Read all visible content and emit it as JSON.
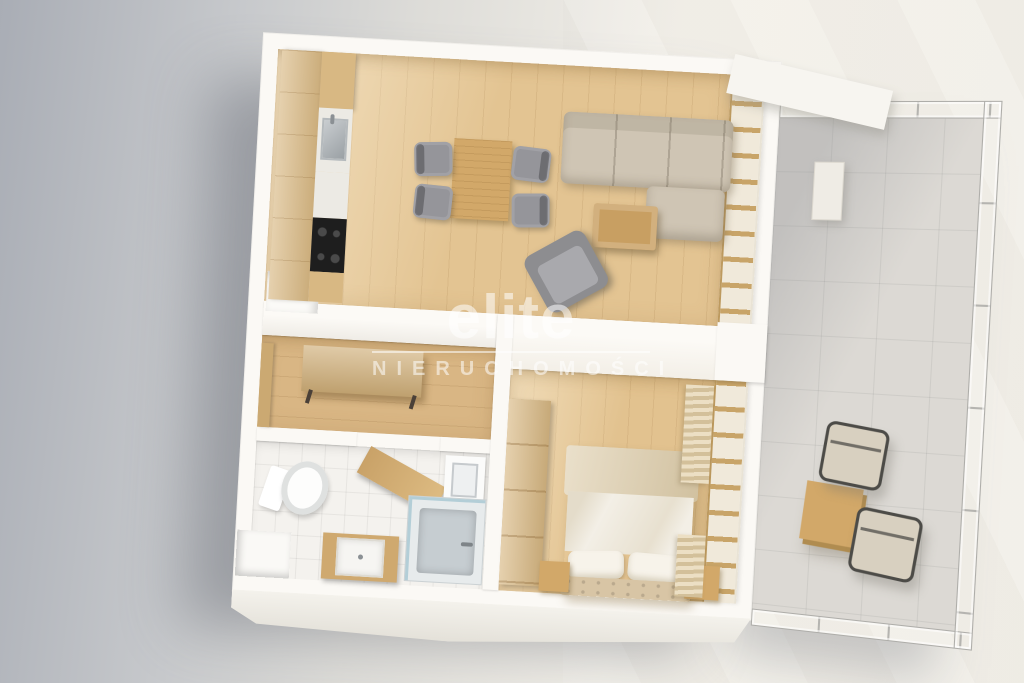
{
  "watermark": {
    "brand": "elite",
    "subtitle": "NIERUCHOMOŚCI"
  },
  "palette": {
    "bg-left": "#a9adb5",
    "bg-mid": "#c7c9cc",
    "bg-right": "#f3f0e9",
    "wall": "#fbf9f5",
    "wall-face": "#efece6",
    "wood-floor": "#e3c492",
    "hall-floor": "#d9b684",
    "bedroom-floor": "#e2c28f",
    "wood-cabinet": "#d8b883",
    "wood-furniture": "#d2a869",
    "sofa": "#cfc5b4",
    "chair-gray": "#95959a",
    "armchair-gray": "#8d8d90",
    "balcony-floor": "#dcd9d4",
    "cooktop": "#1e1e1e",
    "shower-tray": "#c6cdd1",
    "bed-linen": "#f3efe6",
    "bed-blanket": "#dccba8",
    "headboard": "#d8c5a5",
    "watermark": "rgba(255,255,255,0.55)"
  }
}
